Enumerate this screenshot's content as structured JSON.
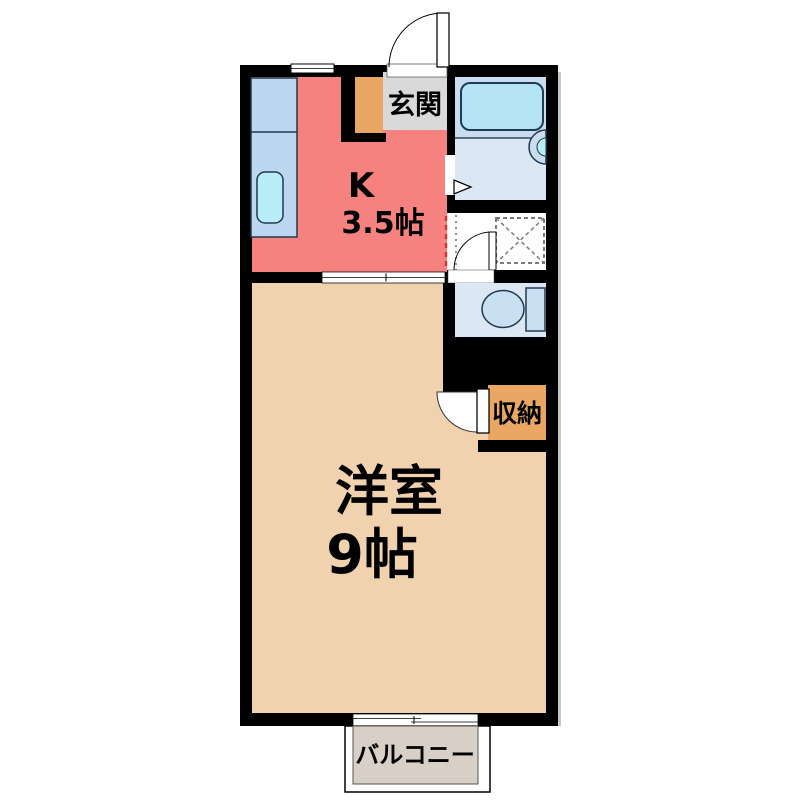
{
  "labels": {
    "entrance": "玄関",
    "kitchen_type": "K",
    "kitchen_size": "3.5帖",
    "main_room_type": "洋室",
    "main_room_size": "9帖",
    "storage": "収納",
    "balcony": "バルコニー"
  },
  "colors": {
    "wall": "#000000",
    "shadow": "#c6c6c6",
    "kitchen": "#f5827f",
    "main_room": "#f1d2ae",
    "entrance_floor": "#d9d9d9",
    "entrance_step": "#e9a763",
    "storage": "#e9a763",
    "bath_upper": "#c9dcf0",
    "bath_lower": "#dbe7f5",
    "toilet_floor": "#dbe7f5",
    "washroom_floor": "#ffffff",
    "balcony_floor": "#d8cfc6",
    "counter": "#bdd7f0",
    "sink": "#b9eef8",
    "bathtub": "#b4e4f4",
    "toilet_fixture": "#c9dff2",
    "opening_red": "#e03030",
    "dash_gray": "#909090",
    "pan_gray": "#7a7a7a"
  }
}
